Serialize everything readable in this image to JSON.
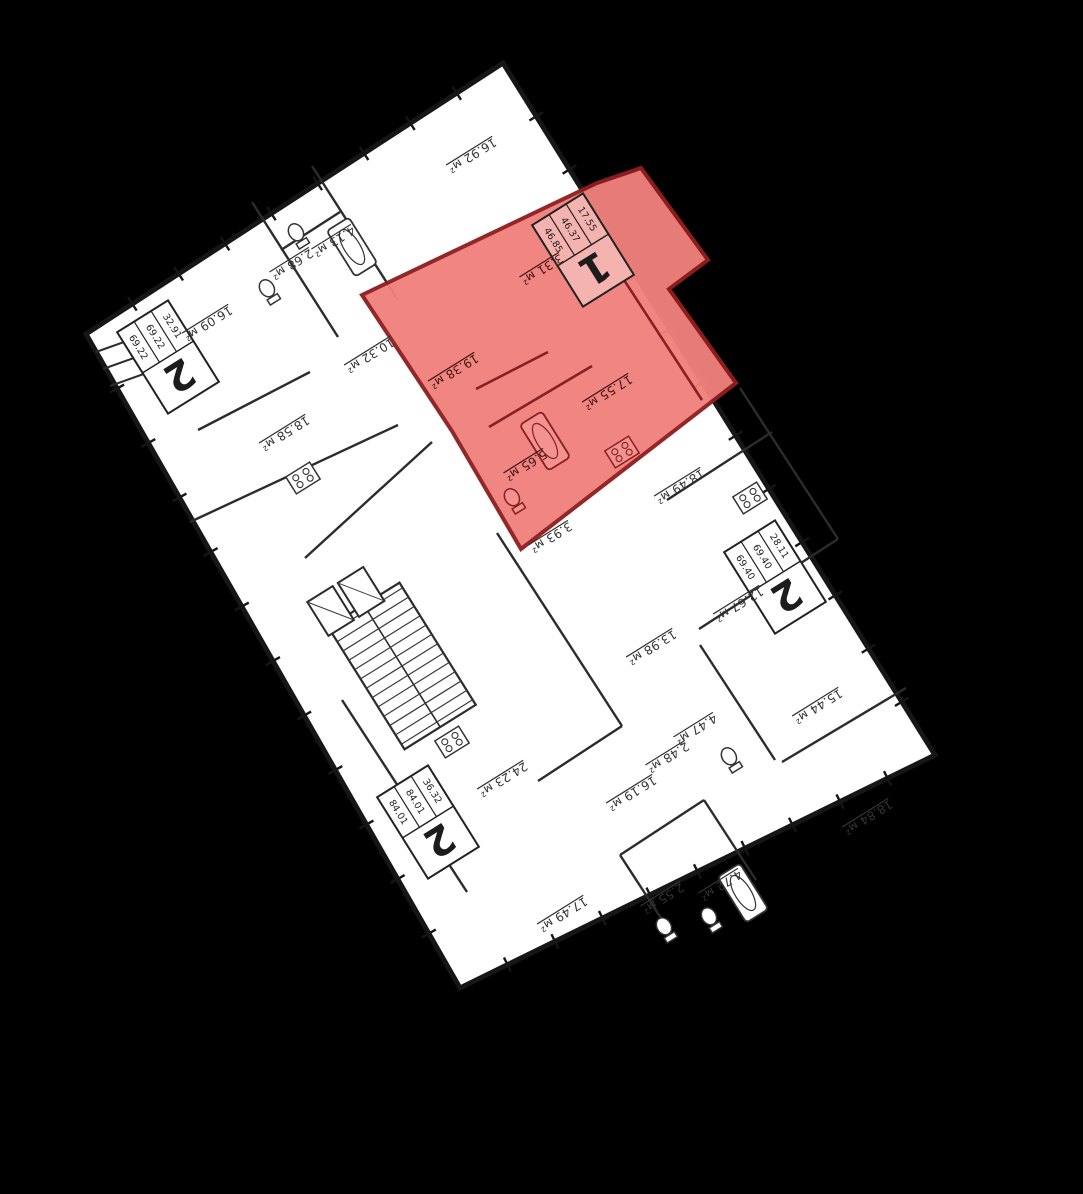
{
  "title": "floor-plan",
  "units": "м²",
  "colors": {
    "background": "#000000",
    "floor": "#ffffff",
    "walls": "#161616",
    "thin_wall": "#2c2c2c",
    "highlight_fill": "#f1817c",
    "highlight_line": "#8f1f1f",
    "highlight_wall": "#872020",
    "label_ink": "#333333",
    "label_ink_red": "#431310",
    "plate_fill": "#ffffff",
    "plate_fill_red": "#f5b3af"
  },
  "text_rotation_deg": 148,
  "highlighted_apartment": {
    "number": "1",
    "stats": [
      "17.55",
      "46.37",
      "46.85"
    ]
  },
  "apartments": [
    {
      "number": "2",
      "stats": [
        "32.91",
        "69.22",
        "69.22"
      ],
      "x": 168,
      "y": 357,
      "highlighted": false
    },
    {
      "number": "1",
      "stats": [
        "17.55",
        "46.37",
        "46.85"
      ],
      "x": 583,
      "y": 250,
      "highlighted": true
    },
    {
      "number": "2",
      "stats": [
        "28.11",
        "69.40",
        "69.40"
      ],
      "x": 775,
      "y": 577,
      "highlighted": false
    },
    {
      "number": "2",
      "stats": [
        "36.32",
        "84.01",
        "84.01"
      ],
      "x": 428,
      "y": 822,
      "highlighted": false
    }
  ],
  "room_labels": [
    {
      "text": "16.92 м²",
      "x": 470,
      "y": 152,
      "zone": "white"
    },
    {
      "text": "4.13 м²",
      "x": 332,
      "y": 238,
      "zone": "white"
    },
    {
      "text": "2.68 м²",
      "x": 290,
      "y": 261,
      "zone": "white"
    },
    {
      "text": "16.09 м²",
      "x": 206,
      "y": 320,
      "zone": "white"
    },
    {
      "text": "18.58 м²",
      "x": 283,
      "y": 430,
      "zone": "white"
    },
    {
      "text": "10.32 м²",
      "x": 368,
      "y": 352,
      "zone": "white"
    },
    {
      "text": "19.38 м²",
      "x": 452,
      "y": 368,
      "zone": "red"
    },
    {
      "text": "17.55 м²",
      "x": 606,
      "y": 389,
      "zone": "red"
    },
    {
      "text": "3.31 м²",
      "x": 540,
      "y": 266,
      "zone": "red"
    },
    {
      "text": "5.65 м²",
      "x": 524,
      "y": 462,
      "zone": "red"
    },
    {
      "text": "3.93 м²",
      "x": 549,
      "y": 534,
      "zone": "white"
    },
    {
      "text": "18.49 м²",
      "x": 678,
      "y": 483,
      "zone": "white"
    },
    {
      "text": "12.67 м²",
      "x": 737,
      "y": 601,
      "zone": "white"
    },
    {
      "text": "13.98 м²",
      "x": 650,
      "y": 644,
      "zone": "white"
    },
    {
      "text": "15.44 м²",
      "x": 816,
      "y": 703,
      "zone": "white"
    },
    {
      "text": "4.47 м²",
      "x": 694,
      "y": 726,
      "zone": "white"
    },
    {
      "text": "2.48 м²",
      "x": 666,
      "y": 754,
      "zone": "white"
    },
    {
      "text": "18.84 м²",
      "x": 866,
      "y": 814,
      "zone": "white"
    },
    {
      "text": "16.19 м²",
      "x": 630,
      "y": 790,
      "zone": "white"
    },
    {
      "text": "24.23 м²",
      "x": 501,
      "y": 776,
      "zone": "white"
    },
    {
      "text": "17.49 м²",
      "x": 561,
      "y": 911,
      "zone": "white"
    },
    {
      "text": "2.55 м²",
      "x": 661,
      "y": 895,
      "zone": "white"
    },
    {
      "text": "4.72 м²",
      "x": 719,
      "y": 882,
      "zone": "white"
    }
  ]
}
